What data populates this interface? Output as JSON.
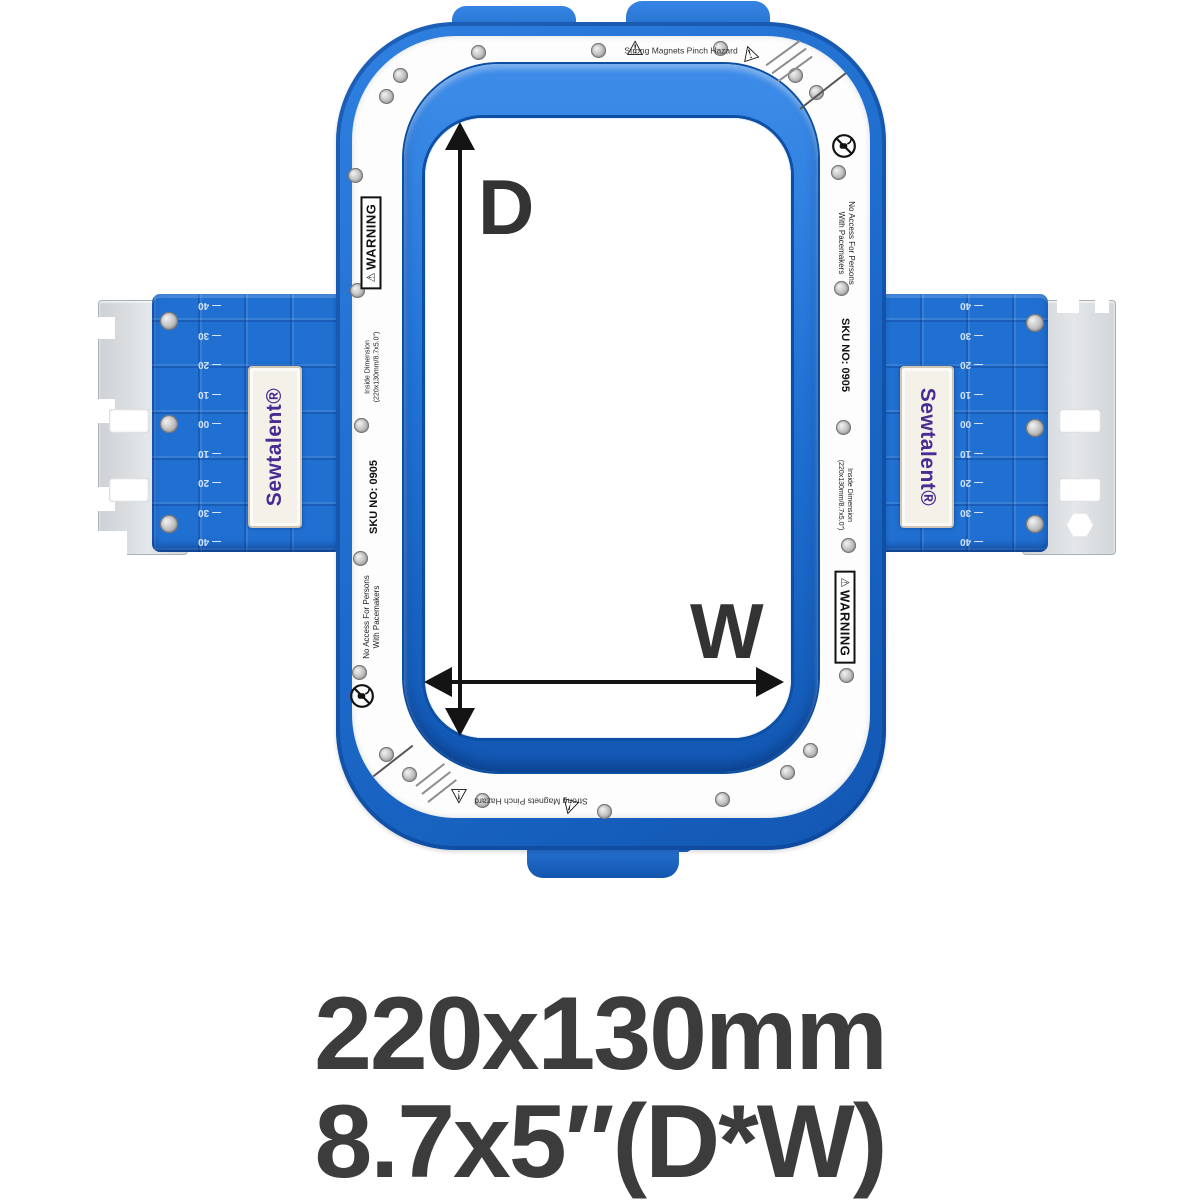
{
  "brand": {
    "name": "Sewtalent®"
  },
  "dimensions": {
    "depth": "D",
    "width": "W"
  },
  "caption": {
    "line1": "220x130mm",
    "line2": "8.7x5″(D*W)"
  },
  "labels": {
    "warning_symbol": "⚠",
    "warning": "WARNING",
    "strong_magnets": [
      "Strong Magnets",
      "Pinch Hazard"
    ],
    "no_access": [
      "No Access For Persons",
      "With Pacemakers"
    ],
    "inside_dimension": [
      "Inside Dimension",
      "(220x130mm/8.7x5.0\")"
    ],
    "sku": "SKU NO: 0905"
  },
  "ruler_ticks": [
    "40",
    "30",
    "20",
    "10",
    "00",
    "10",
    "20",
    "30",
    "40"
  ],
  "colors": {
    "frame_blue": "#2070d2",
    "frame_blue_dark": "#0d4fa4",
    "brand_purple": "#4a2b94",
    "caption_gray": "#3c3c3c",
    "metal_gray": "#d8dbde"
  }
}
